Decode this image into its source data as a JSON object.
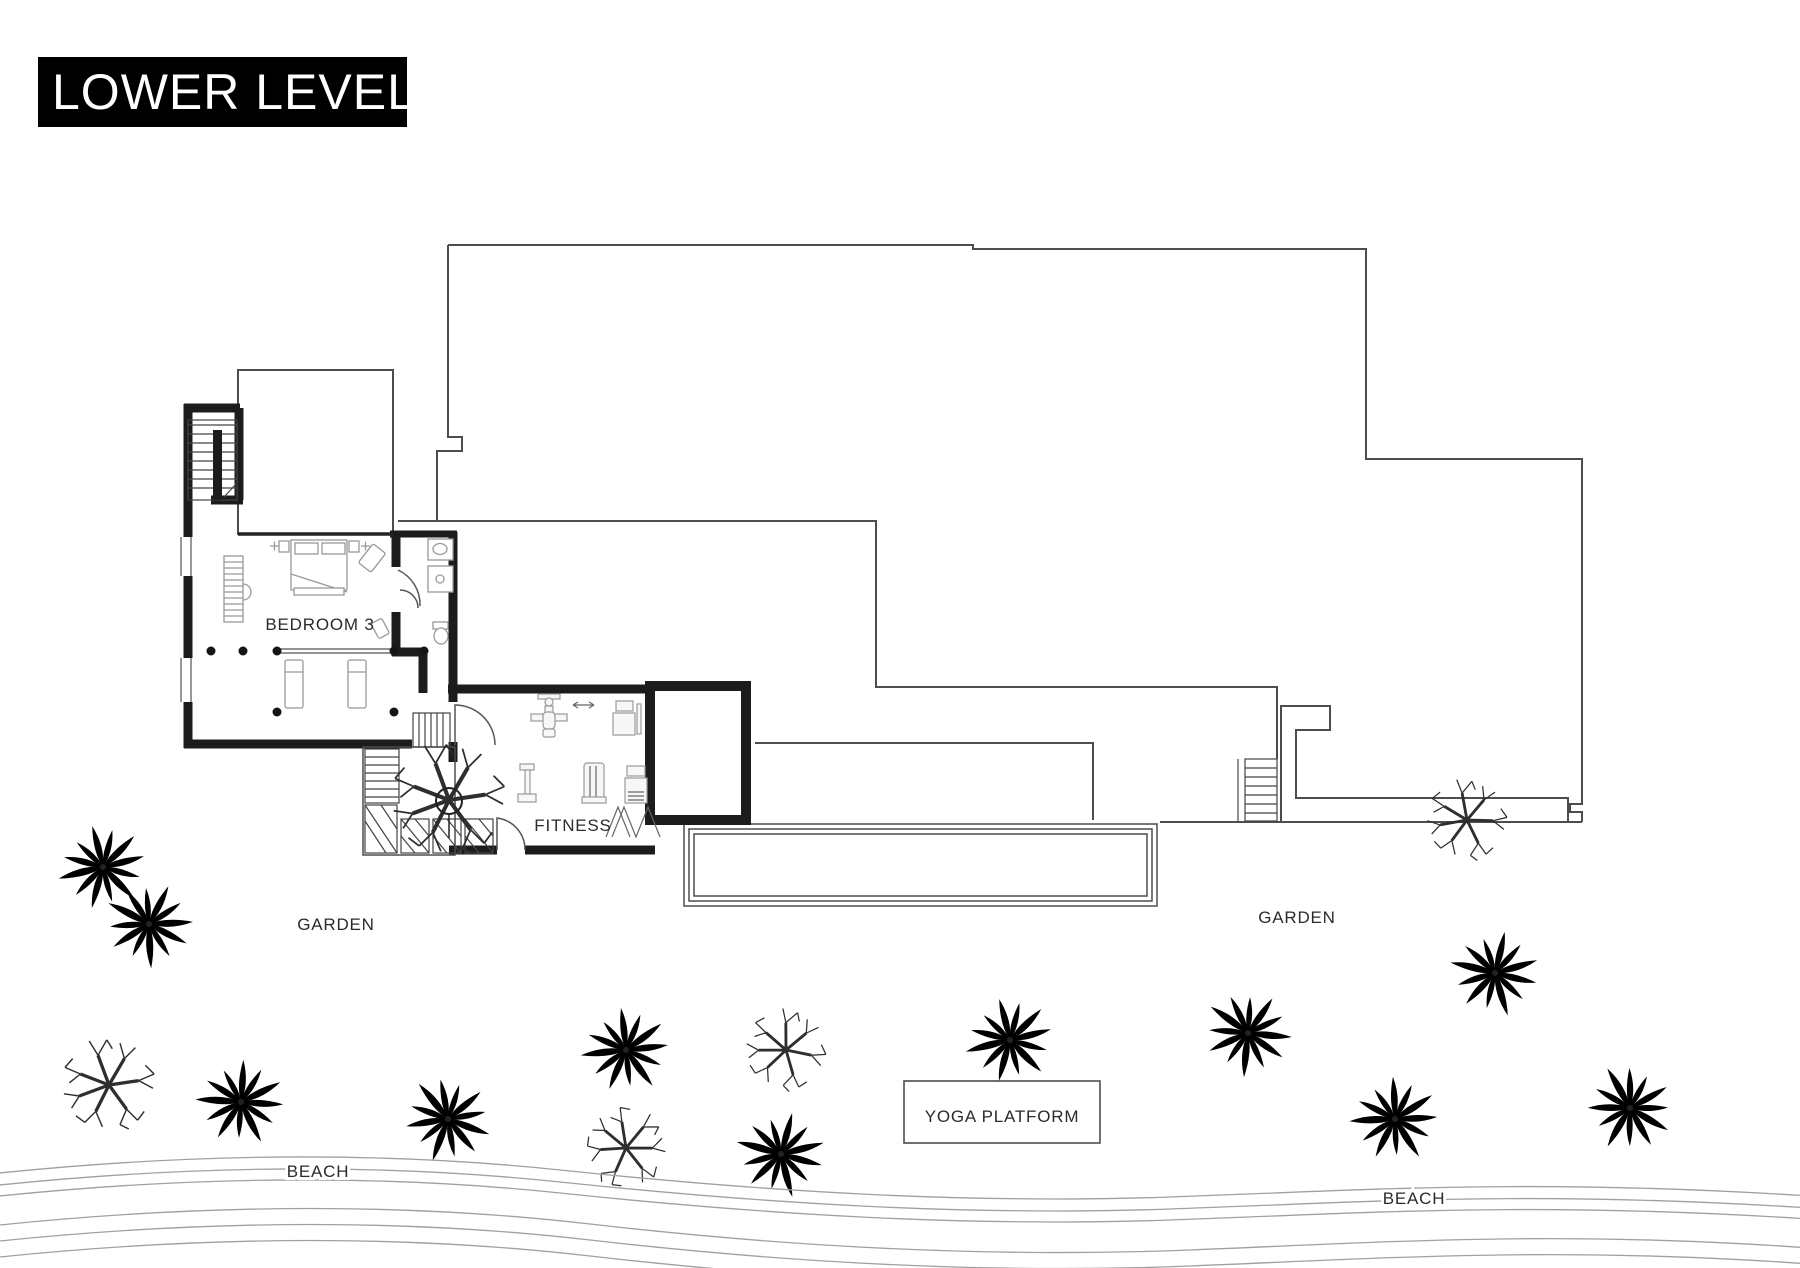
{
  "title": "LOWER LEVEL",
  "rooms": {
    "bedroom3": "BEDROOM 3",
    "fitness": "FITNESS"
  },
  "outdoor": {
    "garden_west": "GARDEN",
    "garden_east": "GARDEN",
    "beach_west": "BEACH",
    "beach_east": "BEACH",
    "yoga_platform": "YOGA PLATFORM"
  },
  "colors": {
    "background": "#ffffff",
    "title_bg": "#000000",
    "title_fg": "#ffffff",
    "wall": "#1c1c1c",
    "outline": "#4d4d4d",
    "label": "#2b2b2b",
    "furniture": "#999999",
    "tree": "#2e2e2e",
    "wave": "#a0a0a0"
  }
}
